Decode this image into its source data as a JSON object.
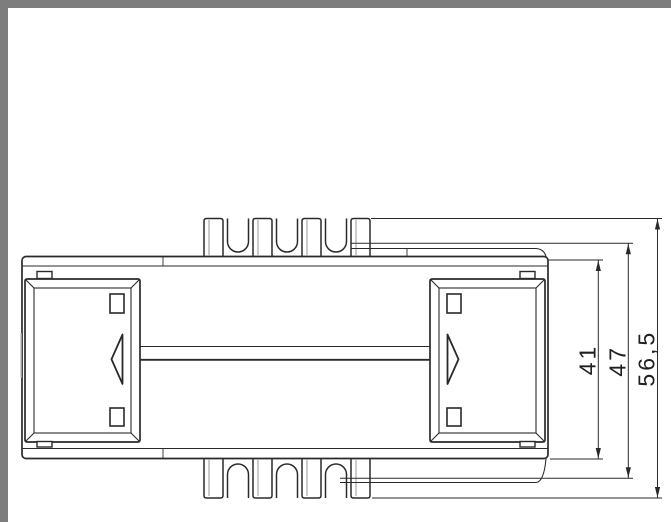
{
  "window": {
    "frame_color": "#7d7d7d",
    "canvas_color": "#ffffff"
  },
  "drawing": {
    "ink_color": "#2a2a2a",
    "description_labels": {},
    "dimensions": [
      {
        "label": "41"
      },
      {
        "label": "47"
      },
      {
        "label": "56,5"
      }
    ]
  }
}
